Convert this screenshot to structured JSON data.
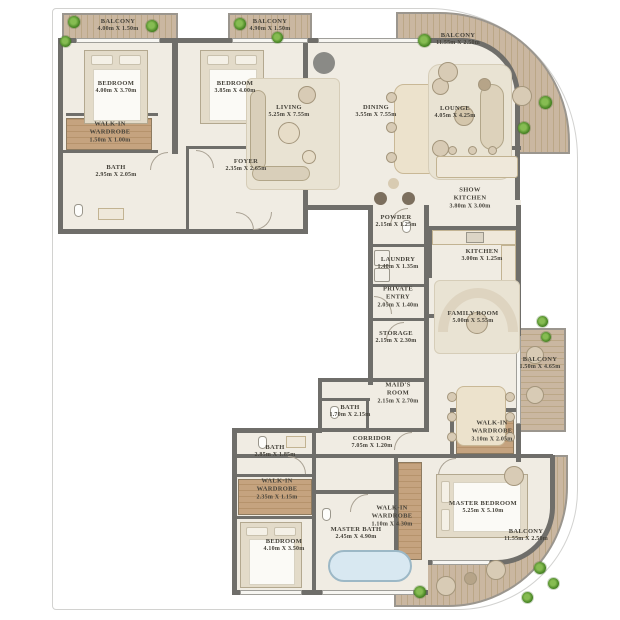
{
  "plan_title": "Apartment Floor Plan",
  "palette": {
    "wall": "#6f6e6a",
    "floor": "#f0ece3",
    "deck_wood": "#cab7a1",
    "wardrobe_wood": "#c5a37f",
    "plant_green": "#3f7d1d",
    "tub_blue": "#d8e8f1",
    "label_text": "#45423a"
  },
  "rooms": {
    "balcony_tl": {
      "name": "BALCONY",
      "dims": "4.00m X 1.50m"
    },
    "balcony_tm": {
      "name": "BALCONY",
      "dims": "4.90m X 1.50m"
    },
    "balcony_tr": {
      "name": "BALCONY",
      "dims": "11.55m X 2.50m"
    },
    "bedroom_1": {
      "name": "BEDROOM",
      "dims": "4.00m X 3.70m"
    },
    "bedroom_2": {
      "name": "BEDROOM",
      "dims": "3.85m X 4.00m"
    },
    "wardrobe_tl": {
      "name": "WALK-IN WARDROBE",
      "dims": "1.50m X 1.00m"
    },
    "bath_tl": {
      "name": "BATH",
      "dims": "2.95m X 2.05m"
    },
    "foyer": {
      "name": "FOYER",
      "dims": "2.35m X 2.65m"
    },
    "living": {
      "name": "LIVING",
      "dims": "5.25m X 7.55m"
    },
    "dining": {
      "name": "DINING",
      "dims": "3.55m X 7.55m"
    },
    "lounge": {
      "name": "LOUNGE",
      "dims": "4.05m X 4.25m"
    },
    "show_kitchen": {
      "name": "SHOW KITCHEN",
      "dims": "3.80m X 3.00m"
    },
    "powder": {
      "name": "POWDER",
      "dims": "2.15m X 1.25m"
    },
    "laundry": {
      "name": "LAUNDRY",
      "dims": "1.40m X 1.35m"
    },
    "kitchen": {
      "name": "KITCHEN",
      "dims": "3.00m X 1.25m"
    },
    "private_entry": {
      "name": "PRIVATE ENTRY",
      "dims": "2.05m X 1.40m"
    },
    "storage": {
      "name": "STORAGE",
      "dims": "2.15m X 2.30m"
    },
    "family_room": {
      "name": "FAMILY ROOM",
      "dims": "5.00m X 5.55m"
    },
    "balcony_r": {
      "name": "BALCONY",
      "dims": "1.50m X 4.65m"
    },
    "maids_room": {
      "name": "MAID'S ROOM",
      "dims": "2.15m X 2.70m"
    },
    "bath_mid": {
      "name": "BATH",
      "dims": "1.70m X 2.15m"
    },
    "corridor": {
      "name": "CORRIDOR",
      "dims": "7.05m X 1.20m"
    },
    "wardrobe_r": {
      "name": "WALK-IN WARDROBE",
      "dims": "3.10m X 2.05m"
    },
    "bath_bl": {
      "name": "BATH",
      "dims": "2.85m X 1.85m"
    },
    "wardrobe_bl": {
      "name": "WALK-IN WARDROBE",
      "dims": "2.35m X 1.15m"
    },
    "bedroom_3": {
      "name": "BEDROOM",
      "dims": "4.10m X 3.50m"
    },
    "wardrobe_master": {
      "name": "WALK-IN WARDROBE",
      "dims": "1.10m X 4.30m"
    },
    "master_bath": {
      "name": "MASTER BATH",
      "dims": "2.45m X 4.90m"
    },
    "master_bedroom": {
      "name": "MASTER BEDROOM",
      "dims": "5.25m X 5.10m"
    },
    "balcony_br": {
      "name": "BALCONY",
      "dims": "11.55m X 2.50m"
    }
  }
}
